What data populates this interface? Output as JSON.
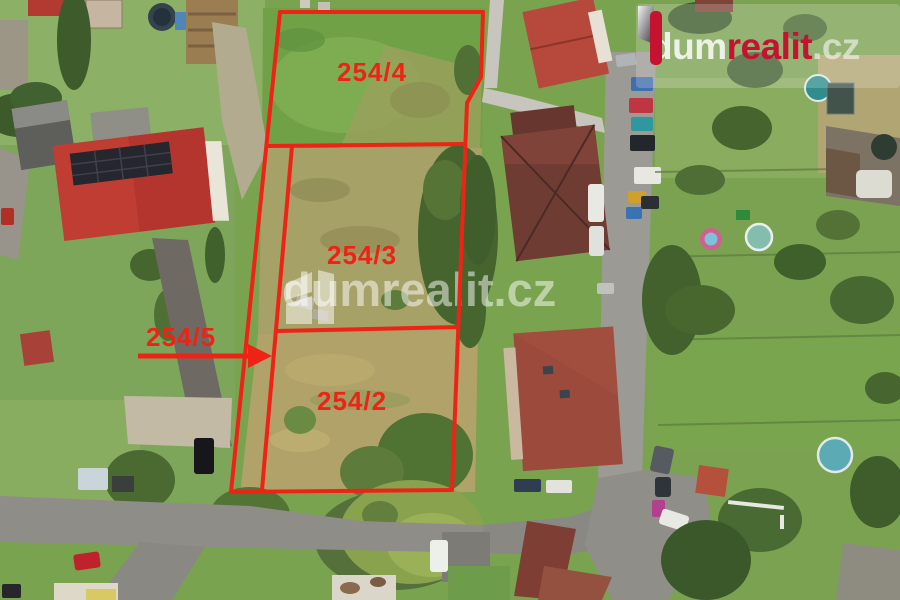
{
  "brand": {
    "logo_dum": "dum",
    "logo_realit": "realit",
    "logo_cz": ".cz",
    "watermark_text": "dumrealit.cz"
  },
  "overlay": {
    "color": "#ee2316",
    "parcels": [
      {
        "label": "254/4"
      },
      {
        "label": "254/3"
      },
      {
        "label": "254/2"
      },
      {
        "label": "254/5"
      }
    ]
  },
  "colors": {
    "overlay_red": "#ee2316",
    "brand_red": "#c41230",
    "watermark_white": "rgba(255,255,255,0.5)",
    "grass_green": "#7aa34f",
    "dry_grass": "#ada068",
    "road_gray": "#8f8d87"
  }
}
